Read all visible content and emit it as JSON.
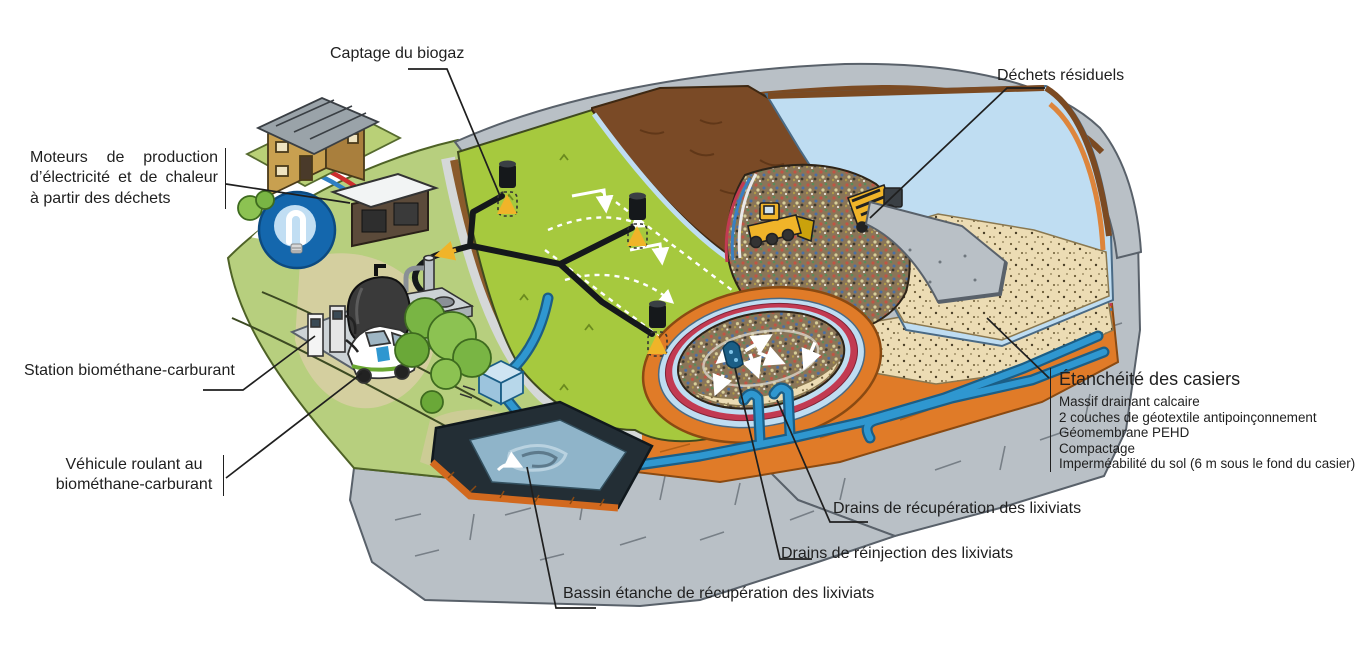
{
  "diagram": {
    "language": "fr",
    "subject": "landfill-biogas-leachate-cross-section"
  },
  "labels": {
    "captage_biogaz": "Captage du biogaz",
    "dechets_residuels": "Déchets résiduels",
    "moteurs": "Moteurs de production d’électricité et de chaleur à partir des déchets",
    "station": "Station biométhane-carburant",
    "vehicule": "Véhicule roulant au biométhane-carburant",
    "etancheite": {
      "title": "Étanchéité des casiers",
      "items": [
        "Massif drainant calcaire",
        "2 couches de géotextile antipoinçonnement",
        "Géomembrane PEHD",
        "Compactage",
        "Imperméabilité du sol (6 m sous le fond du casier)"
      ]
    },
    "drains_recuperation": "Drains de récupération des lixiviats",
    "drains_reinjection": "Drains de réinjection des lixiviats",
    "bassin": "Bassin étanche de récupération des lixiviats"
  },
  "colors": {
    "rock": "#b9c0c6",
    "rock-line": "#6e767d",
    "grass-hill": "#b7cf7e",
    "grass-cap": "#a6c93e",
    "soil-brown": "#7a4a26",
    "clay-orange": "#e07b28",
    "membrane-blue": "#bfddf2",
    "geotextile-red": "#c23a52",
    "sand": "#ecdcb4",
    "water": "#8fb4c9",
    "pipe-blue": "#2f97d0",
    "arrow-yellow": "#f0b429",
    "bulb-blue": "#1467ad"
  }
}
